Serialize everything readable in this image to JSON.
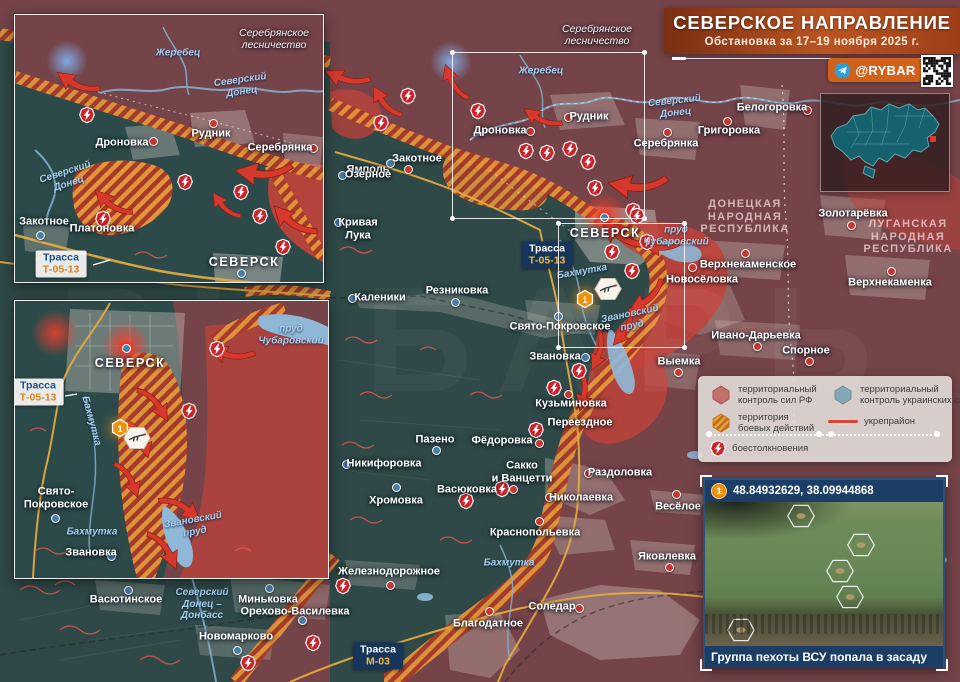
{
  "banner": {
    "title": "СЕВЕРСКОЕ НАПРАВЛЕНИЕ",
    "subtitle": "Обстановка за 17–19 ноября 2025 г.",
    "handle": "@RYBAR",
    "watermark": "РЫБАРЬ"
  },
  "legend": {
    "items": [
      {
        "type": "hex-rf",
        "label": "территориальный\nконтроль сил РФ"
      },
      {
        "type": "hex-ua",
        "label": "территориальный\nконтроль украинских сил"
      },
      {
        "type": "hex-combat",
        "label": "территория\nбоевых действий"
      },
      {
        "type": "line",
        "label": "укрепрайон"
      },
      {
        "type": "clash",
        "label": "боестолкновения"
      }
    ]
  },
  "photo": {
    "marker": "1",
    "coords": "48.84932629, 38.09944868",
    "caption": "Группа пехоты ВСУ попала в засаду",
    "hexes": [
      {
        "x": 96,
        "y": 14
      },
      {
        "x": 156,
        "y": 43
      },
      {
        "x": 135,
        "y": 69
      },
      {
        "x": 145,
        "y": 95
      },
      {
        "x": 36,
        "y": 128
      }
    ]
  },
  "colors": {
    "rf": "#744449",
    "ua": "#2e4947",
    "combat_orange": "#e2953c",
    "combat_stripe": "#a83a28",
    "advance_red": "#c2423a",
    "accent_orange": "#d2611c",
    "clash_red": "#c9252b",
    "navy": "#1c3e66"
  },
  "maps": [
    {
      "id": "main",
      "labels": [
        {
          "t": "Ямполь",
          "x": 368,
          "y": 170,
          "c": "city"
        },
        {
          "t": "Рудник",
          "x": 589,
          "y": 117,
          "c": "city"
        },
        {
          "t": "Дроновка",
          "x": 500,
          "y": 131,
          "c": "city"
        },
        {
          "t": "Серебрянка",
          "x": 666,
          "y": 144,
          "c": "city"
        },
        {
          "t": "Белогоровка",
          "x": 772,
          "y": 108,
          "c": "city"
        },
        {
          "t": "Григоровка",
          "x": 729,
          "y": 131,
          "c": "city"
        },
        {
          "t": "Золотарёвка",
          "x": 853,
          "y": 214,
          "c": "city"
        },
        {
          "t": "Верхнекаменское",
          "x": 748,
          "y": 265,
          "c": "city"
        },
        {
          "t": "Новосёловка",
          "x": 702,
          "y": 280,
          "c": "city"
        },
        {
          "t": "Верхнекаменка",
          "x": 890,
          "y": 283,
          "c": "city"
        },
        {
          "t": "Ивано-Дарьевка",
          "x": 756,
          "y": 336,
          "c": "city"
        },
        {
          "t": "Спорное",
          "x": 806,
          "y": 351,
          "c": "city"
        },
        {
          "t": "Выемка",
          "x": 679,
          "y": 362,
          "c": "city"
        },
        {
          "t": "Каленики",
          "x": 380,
          "y": 298,
          "c": "city"
        },
        {
          "t": "Резниковка",
          "x": 457,
          "y": 291,
          "c": "city"
        },
        {
          "t": "Свято-Покровское",
          "x": 560,
          "y": 327,
          "c": "city"
        },
        {
          "t": "Звановка",
          "x": 555,
          "y": 357,
          "c": "city"
        },
        {
          "t": "Кузьминовка",
          "x": 571,
          "y": 404,
          "c": "city"
        },
        {
          "t": "Переездное",
          "x": 580,
          "y": 423,
          "c": "city"
        },
        {
          "t": "Пазено",
          "x": 435,
          "y": 440,
          "c": "city"
        },
        {
          "t": "Фёдоровка",
          "x": 502,
          "y": 441,
          "c": "city"
        },
        {
          "t": "Никифоровка",
          "x": 384,
          "y": 464,
          "c": "city"
        },
        {
          "t": "Хромовка",
          "x": 396,
          "y": 501,
          "c": "city"
        },
        {
          "t": "Васюковка",
          "x": 467,
          "y": 490,
          "c": "city"
        },
        {
          "t": "Сакко\nи Ванцетти",
          "x": 522,
          "y": 472,
          "c": "city"
        },
        {
          "t": "Раздоловка",
          "x": 620,
          "y": 473,
          "c": "city"
        },
        {
          "t": "Николаевка",
          "x": 581,
          "y": 498,
          "c": "city"
        },
        {
          "t": "Краснопольевка",
          "x": 535,
          "y": 533,
          "c": "city"
        },
        {
          "t": "Весёлое",
          "x": 678,
          "y": 507,
          "c": "city"
        },
        {
          "t": "Яковлевка",
          "x": 667,
          "y": 557,
          "c": "city"
        },
        {
          "t": "Железнодорожное",
          "x": 389,
          "y": 572,
          "c": "city"
        },
        {
          "t": "Соледар",
          "x": 552,
          "y": 607,
          "c": "city"
        },
        {
          "t": "Благодатное",
          "x": 488,
          "y": 624,
          "c": "city"
        },
        {
          "t": "Васютинское",
          "x": 126,
          "y": 600,
          "c": "city"
        },
        {
          "t": "Миньковка",
          "x": 268,
          "y": 600,
          "c": "city"
        },
        {
          "t": "Орехово-Василевка",
          "x": 295,
          "y": 612,
          "c": "city"
        },
        {
          "t": "Новомарково",
          "x": 236,
          "y": 637,
          "c": "city"
        },
        {
          "t": "СЕВЕРСК",
          "x": 605,
          "y": 233,
          "c": "city caps"
        },
        {
          "t": "Кривая\nЛука",
          "x": 358,
          "y": 229,
          "c": "city"
        },
        {
          "t": "Озерное",
          "x": 368,
          "y": 175,
          "c": "city"
        },
        {
          "t": "Закотное",
          "x": 417,
          "y": 159,
          "c": "city"
        },
        {
          "t": "ДОНЕЦКАЯ\nНАРОДНАЯ\nРЕСПУБЛИКА",
          "x": 745,
          "y": 217,
          "c": "region"
        },
        {
          "t": "ЛУГАНСКАЯ\nНАРОДНАЯ\nРЕСПУБЛИКА",
          "x": 908,
          "y": 237,
          "c": "region"
        },
        {
          "t": "Жеребец",
          "x": 541,
          "y": 71,
          "c": "water"
        },
        {
          "t": "Северский\nДонец",
          "x": 675,
          "y": 107,
          "c": "water",
          "r": -6
        },
        {
          "t": "Бахмутка",
          "x": 582,
          "y": 272,
          "c": "water",
          "r": -10
        },
        {
          "t": "пруд\nЧубаровский",
          "x": 676,
          "y": 236,
          "c": "water"
        },
        {
          "t": "Звановский\nпруд",
          "x": 631,
          "y": 320,
          "c": "water",
          "r": -12
        },
        {
          "t": "Бахмутка",
          "x": 509,
          "y": 563,
          "c": "water"
        },
        {
          "t": "Северский\nДонец –\nДонбасс",
          "x": 202,
          "y": 604,
          "c": "water"
        },
        {
          "t": "Серебрянское\nлесничество",
          "x": 597,
          "y": 35,
          "c": "forest"
        }
      ],
      "roads": [
        {
          "lines": [
            "Трасса",
            "Т-05-13"
          ],
          "x": 547,
          "y": 255,
          "style": "dark"
        },
        {
          "lines": [
            "Трасса",
            "М-03"
          ],
          "x": 378,
          "y": 656,
          "style": "dark"
        }
      ],
      "dots": [
        {
          "x": 408,
          "y": 169,
          "c": "r"
        },
        {
          "x": 568,
          "y": 117,
          "c": "r"
        },
        {
          "x": 530,
          "y": 131,
          "c": "r"
        },
        {
          "x": 667,
          "y": 132,
          "c": "r"
        },
        {
          "x": 807,
          "y": 110,
          "c": "r"
        },
        {
          "x": 727,
          "y": 121,
          "c": "r"
        },
        {
          "x": 851,
          "y": 225,
          "c": "r"
        },
        {
          "x": 745,
          "y": 253,
          "c": "r"
        },
        {
          "x": 692,
          "y": 267,
          "c": "r"
        },
        {
          "x": 891,
          "y": 271,
          "c": "r"
        },
        {
          "x": 757,
          "y": 346,
          "c": "r"
        },
        {
          "x": 809,
          "y": 361,
          "c": "r"
        },
        {
          "x": 678,
          "y": 372,
          "c": "r"
        },
        {
          "x": 352,
          "y": 298,
          "c": "b"
        },
        {
          "x": 455,
          "y": 302,
          "c": "b"
        },
        {
          "x": 558,
          "y": 316,
          "c": "b"
        },
        {
          "x": 585,
          "y": 357,
          "c": "b"
        },
        {
          "x": 568,
          "y": 394,
          "c": "r"
        },
        {
          "x": 436,
          "y": 450,
          "c": "b"
        },
        {
          "x": 539,
          "y": 443,
          "c": "r"
        },
        {
          "x": 346,
          "y": 464,
          "c": "b"
        },
        {
          "x": 396,
          "y": 487,
          "c": "b"
        },
        {
          "x": 513,
          "y": 489,
          "c": "r"
        },
        {
          "x": 588,
          "y": 473,
          "c": "r"
        },
        {
          "x": 549,
          "y": 497,
          "c": "r"
        },
        {
          "x": 539,
          "y": 521,
          "c": "r"
        },
        {
          "x": 676,
          "y": 494,
          "c": "r"
        },
        {
          "x": 669,
          "y": 567,
          "c": "r"
        },
        {
          "x": 390,
          "y": 585,
          "c": "r"
        },
        {
          "x": 579,
          "y": 608,
          "c": "r"
        },
        {
          "x": 489,
          "y": 611,
          "c": "r"
        },
        {
          "x": 128,
          "y": 590,
          "c": "b"
        },
        {
          "x": 269,
          "y": 588,
          "c": "b"
        },
        {
          "x": 302,
          "y": 620,
          "c": "b"
        },
        {
          "x": 237,
          "y": 650,
          "c": "b"
        },
        {
          "x": 604,
          "y": 217,
          "c": "b",
          "g": true
        },
        {
          "x": 338,
          "y": 222,
          "c": "b"
        },
        {
          "x": 342,
          "y": 175,
          "c": "b"
        },
        {
          "x": 390,
          "y": 163,
          "c": "b"
        }
      ],
      "icons": [
        {
          "t": "clash",
          "x": 408,
          "y": 96
        },
        {
          "t": "clash",
          "x": 478,
          "y": 111
        },
        {
          "t": "clash",
          "x": 381,
          "y": 123
        },
        {
          "t": "clash",
          "x": 526,
          "y": 151
        },
        {
          "t": "clash",
          "x": 547,
          "y": 153
        },
        {
          "t": "clash",
          "x": 570,
          "y": 149
        },
        {
          "t": "clash",
          "x": 588,
          "y": 162
        },
        {
          "t": "clash",
          "x": 595,
          "y": 188
        },
        {
          "t": "clash",
          "x": 633,
          "y": 211
        },
        {
          "t": "clash",
          "x": 637,
          "y": 216
        },
        {
          "t": "clash",
          "x": 612,
          "y": 252
        },
        {
          "t": "clash",
          "x": 632,
          "y": 271
        },
        {
          "t": "clash",
          "x": 647,
          "y": 242
        },
        {
          "t": "clash",
          "x": 579,
          "y": 371
        },
        {
          "t": "clash",
          "x": 554,
          "y": 388
        },
        {
          "t": "clash",
          "x": 536,
          "y": 430
        },
        {
          "t": "clash",
          "x": 466,
          "y": 501
        },
        {
          "t": "clash",
          "x": 502,
          "y": 489
        },
        {
          "t": "clash",
          "x": 343,
          "y": 586
        },
        {
          "t": "clash",
          "x": 248,
          "y": 663
        },
        {
          "t": "clash",
          "x": 313,
          "y": 643
        },
        {
          "t": "ambush",
          "x": 608,
          "y": 289
        },
        {
          "t": "m1",
          "x": 585,
          "y": 299
        }
      ],
      "glows": [
        {
          "x": 604,
          "y": 216,
          "c": "red"
        },
        {
          "x": 451,
          "y": 62,
          "c": "blue"
        }
      ],
      "arrows": [
        {
          "x": 345,
          "y": 80,
          "r": 205,
          "s": 1
        },
        {
          "x": 383,
          "y": 103,
          "r": 240,
          "s": 0.9
        },
        {
          "x": 452,
          "y": 83,
          "r": 250,
          "s": 0.9
        },
        {
          "x": 540,
          "y": 120,
          "r": 215,
          "s": 0.9
        },
        {
          "x": 636,
          "y": 188,
          "r": 190,
          "s": 1.3
        },
        {
          "x": 622,
          "y": 238,
          "r": 220,
          "s": 1.2
        },
        {
          "x": 664,
          "y": 248,
          "r": 185,
          "s": 0.9
        },
        {
          "x": 648,
          "y": 300,
          "r": 150,
          "s": 1
        },
        {
          "x": 626,
          "y": 330,
          "r": 130,
          "s": 0.9
        },
        {
          "x": 600,
          "y": 352,
          "r": 115,
          "s": 0.9
        },
        {
          "x": 585,
          "y": 392,
          "r": 105,
          "s": 0.9
        }
      ]
    },
    {
      "id": "inset1",
      "labels": [
        {
          "t": "Серебрянское\nлесничество",
          "x": 259,
          "y": 24,
          "c": "forest"
        },
        {
          "t": "Жеребец",
          "x": 163,
          "y": 38,
          "c": "water"
        },
        {
          "t": "Северский\nДонец",
          "x": 226,
          "y": 71,
          "c": "water",
          "r": -8
        },
        {
          "t": "Дроновка",
          "x": 107,
          "y": 128,
          "c": "city"
        },
        {
          "t": "Рудник",
          "x": 196,
          "y": 119,
          "c": "city"
        },
        {
          "t": "Серебрянка",
          "x": 265,
          "y": 133,
          "c": "city"
        },
        {
          "t": "Северский\nДонец",
          "x": 52,
          "y": 163,
          "c": "water",
          "r": -18
        },
        {
          "t": "Закотное",
          "x": 29,
          "y": 207,
          "c": "city"
        },
        {
          "t": "Платоновка",
          "x": 87,
          "y": 214,
          "c": "city"
        },
        {
          "t": "СЕВЕРСК",
          "x": 229,
          "y": 247,
          "c": "city caps"
        }
      ],
      "roads": [
        {
          "lines": [
            "Трасса",
            "Т-05-13"
          ],
          "x": 46,
          "y": 249,
          "style": "light"
        }
      ],
      "dots": [
        {
          "x": 138,
          "y": 126,
          "c": "r"
        },
        {
          "x": 198,
          "y": 108,
          "c": "r"
        },
        {
          "x": 298,
          "y": 133,
          "c": "r"
        },
        {
          "x": 25,
          "y": 220,
          "c": "b"
        },
        {
          "x": 226,
          "y": 258,
          "c": "b"
        }
      ],
      "icons": [
        {
          "t": "clash",
          "x": 72,
          "y": 100
        },
        {
          "t": "clash",
          "x": 88,
          "y": 204
        },
        {
          "t": "clash",
          "x": 170,
          "y": 167
        },
        {
          "t": "clash",
          "x": 226,
          "y": 177
        },
        {
          "t": "clash",
          "x": 245,
          "y": 201
        },
        {
          "t": "clash",
          "x": 268,
          "y": 232
        }
      ],
      "glows": [
        {
          "x": 52,
          "y": 46,
          "c": "blue"
        }
      ],
      "arrows": [
        {
          "x": 60,
          "y": 70,
          "r": 215,
          "s": 1
        },
        {
          "x": 95,
          "y": 190,
          "r": 225,
          "s": 0.95
        },
        {
          "x": 247,
          "y": 160,
          "r": 190,
          "s": 1.25
        },
        {
          "x": 276,
          "y": 208,
          "r": 225,
          "s": 1.1
        },
        {
          "x": 208,
          "y": 192,
          "r": 235,
          "s": 0.8
        }
      ]
    },
    {
      "id": "inset2",
      "labels": [
        {
          "t": "СЕВЕРСК",
          "x": 115,
          "y": 62,
          "c": "city caps"
        },
        {
          "t": "пруд\nЧубаровский",
          "x": 276,
          "y": 34,
          "c": "water"
        },
        {
          "t": "Бахмутка",
          "x": 76,
          "y": 120,
          "c": "water",
          "r": 75
        },
        {
          "t": "Свято-\nПокровское",
          "x": 41,
          "y": 197,
          "c": "city"
        },
        {
          "t": "Бахмутка",
          "x": 77,
          "y": 231,
          "c": "water"
        },
        {
          "t": "Звановка",
          "x": 76,
          "y": 252,
          "c": "city"
        },
        {
          "t": "Звановский\nпруд",
          "x": 179,
          "y": 225,
          "c": "water",
          "r": -10
        }
      ],
      "roads": [
        {
          "lines": [
            "Трасса",
            "Т-05-13"
          ],
          "x": 23,
          "y": 91,
          "style": "light"
        }
      ],
      "dots": [
        {
          "x": 111,
          "y": 47,
          "c": "b",
          "g": true
        },
        {
          "x": 40,
          "y": 217,
          "c": "b"
        },
        {
          "x": 96,
          "y": 255,
          "c": "b"
        }
      ],
      "icons": [
        {
          "t": "clash",
          "x": 202,
          "y": 48
        },
        {
          "t": "clash",
          "x": 174,
          "y": 110
        },
        {
          "t": "m1",
          "x": 105,
          "y": 127
        },
        {
          "t": "ambush",
          "x": 122,
          "y": 137
        }
      ],
      "glows": [
        {
          "x": 40,
          "y": 32,
          "c": "red"
        },
        {
          "x": 111,
          "y": 44,
          "c": "red"
        }
      ],
      "arrows": [
        {
          "x": 215,
          "y": 55,
          "r": 200,
          "s": 1
        },
        {
          "x": 142,
          "y": 102,
          "r": 60,
          "s": 0.95
        },
        {
          "x": 128,
          "y": 138,
          "r": 75,
          "s": 0.9
        },
        {
          "x": 116,
          "y": 178,
          "r": 70,
          "s": 0.9
        },
        {
          "x": 168,
          "y": 205,
          "r": 40,
          "s": 1
        },
        {
          "x": 152,
          "y": 248,
          "r": 65,
          "s": 1
        }
      ]
    }
  ]
}
